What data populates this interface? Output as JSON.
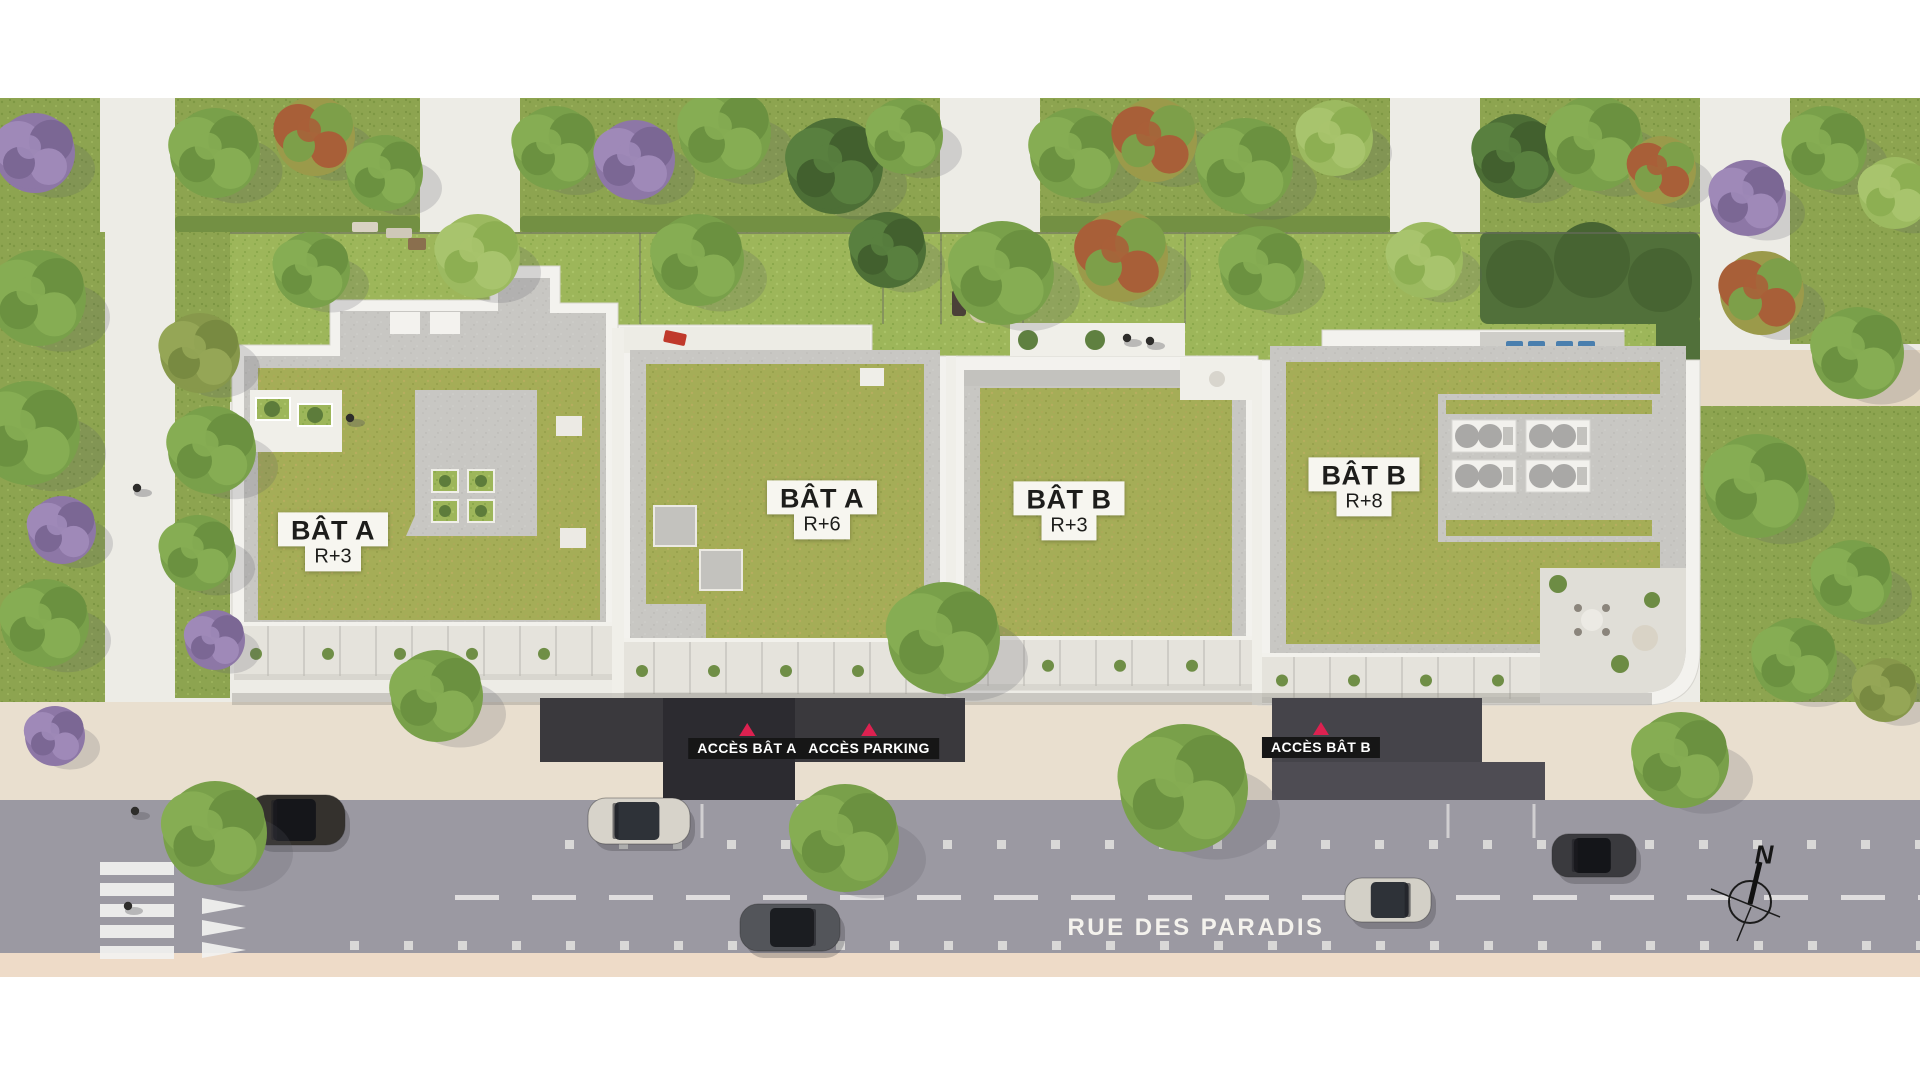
{
  "buildings": [
    {
      "id": "bat-a-r3",
      "name": "BÂT A",
      "floors": "R+3"
    },
    {
      "id": "bat-a-r6",
      "name": "BÂT A",
      "floors": "R+6"
    },
    {
      "id": "bat-b-r3",
      "name": "BÂT B",
      "floors": "R+3"
    },
    {
      "id": "bat-b-r8",
      "name": "BÂT B",
      "floors": "R+8"
    }
  ],
  "access_points": [
    {
      "id": "acces-bat-a",
      "label": "ACCÈS BÂT A"
    },
    {
      "id": "acces-parking",
      "label": "ACCÈS PARKING"
    },
    {
      "id": "acces-bat-b",
      "label": "ACCÈS BÂT B"
    }
  ],
  "street": {
    "name": "RUE DES PARADIS"
  },
  "compass": {
    "north_label": "N"
  },
  "icons": {
    "access_marker": "triangle-up-icon",
    "compass": "north-compass-icon"
  },
  "colors": {
    "road": "#9b99a2",
    "sidewalk": "#e9dfcf",
    "curb_strip": "#eedbc8",
    "roof_grass": "#a5ad57",
    "courtyard_grass": "#9db65a",
    "plot_grass": "#8da450",
    "gravel": "#c8c7c3",
    "building_edge": "#f3f2ee",
    "walkway": "#edece6",
    "label_bg": "#f7f6f0",
    "label_text": "#1d1d1b",
    "access_bg": "#161616",
    "access_text": "#ffffff",
    "access_marker": "#dd2150",
    "street_text": "#f4f2ed",
    "road_marking": "#f2f2f0"
  }
}
